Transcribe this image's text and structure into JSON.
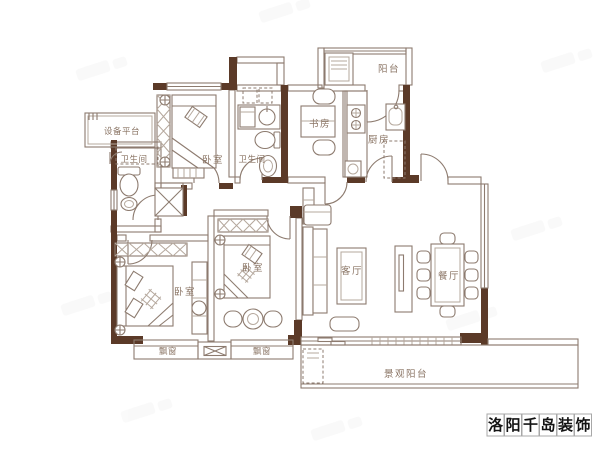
{
  "image_type": "residential-floor-plan",
  "colors": {
    "bg": "#ffffff",
    "wall": "#5b3a28",
    "line": "#8d7b6f",
    "line_light": "#b5a89d",
    "label": "#8a7464",
    "wm_text": "#141414",
    "wm_border": "#a8a8a8",
    "ghost": "#8a8a8a"
  },
  "rooms": [
    {
      "id": "balcony-top",
      "label": "阳台"
    },
    {
      "id": "study",
      "label": "书房"
    },
    {
      "id": "kitchen",
      "label": "厨房"
    },
    {
      "id": "equipment-platform",
      "label": "设备平台"
    },
    {
      "id": "bathroom-left",
      "label": "卫生间"
    },
    {
      "id": "bedroom-top",
      "label": "卧室"
    },
    {
      "id": "bathroom-middle",
      "label": "卫生间"
    },
    {
      "id": "bedroom-bottom-left",
      "label": "卧室"
    },
    {
      "id": "bedroom-bottom-middle",
      "label": "卧室"
    },
    {
      "id": "living-room",
      "label": "客厅"
    },
    {
      "id": "dining-room",
      "label": "餐厅"
    },
    {
      "id": "bay-window-left",
      "label": "飘窗"
    },
    {
      "id": "bay-window-right",
      "label": "飘窗"
    },
    {
      "id": "landscape-balcony",
      "label": "景观阳台"
    }
  ],
  "watermark": {
    "brand": "洛阳千岛装饰",
    "characters": [
      "洛",
      "阳",
      "千",
      "岛",
      "装",
      "饰"
    ]
  }
}
